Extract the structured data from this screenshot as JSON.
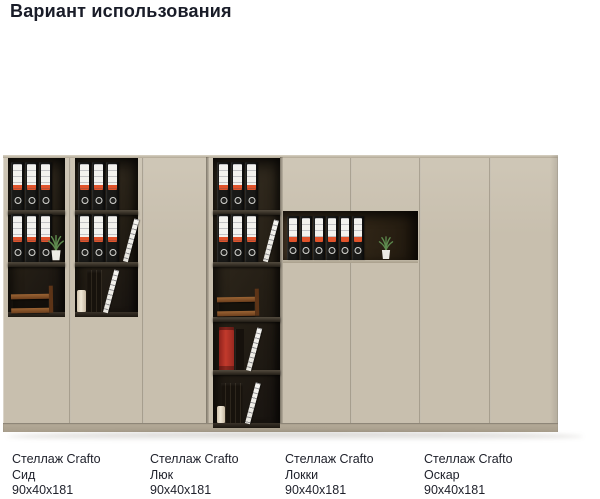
{
  "header": {
    "title": "Вариант использования"
  },
  "products": [
    {
      "line1": "Стеллаж Crafto",
      "name": "Сид",
      "dims": "90x40x181"
    },
    {
      "line1": "Стеллаж Crafto",
      "name": "Люк",
      "dims": "90x40x181"
    },
    {
      "line1": "Стеллаж Crafto",
      "name": "Локки",
      "dims": "90x40x181"
    },
    {
      "line1": "Стеллаж Crafto",
      "name": "Оскар",
      "dims": "90x40x181"
    }
  ],
  "scene": {
    "colors": {
      "door": "#c8bfae",
      "door_light": "#cfc7b7",
      "interior": "#241e15",
      "niche": "#342919",
      "plinth": "#b5ab99",
      "binder_body": "#191917",
      "binder_label": "#f3f2ee",
      "binder_stripe": "#e1532b",
      "accent_red": "#c23a2c",
      "wood": "#7b4a26",
      "plant": "#5d8a4e"
    }
  }
}
